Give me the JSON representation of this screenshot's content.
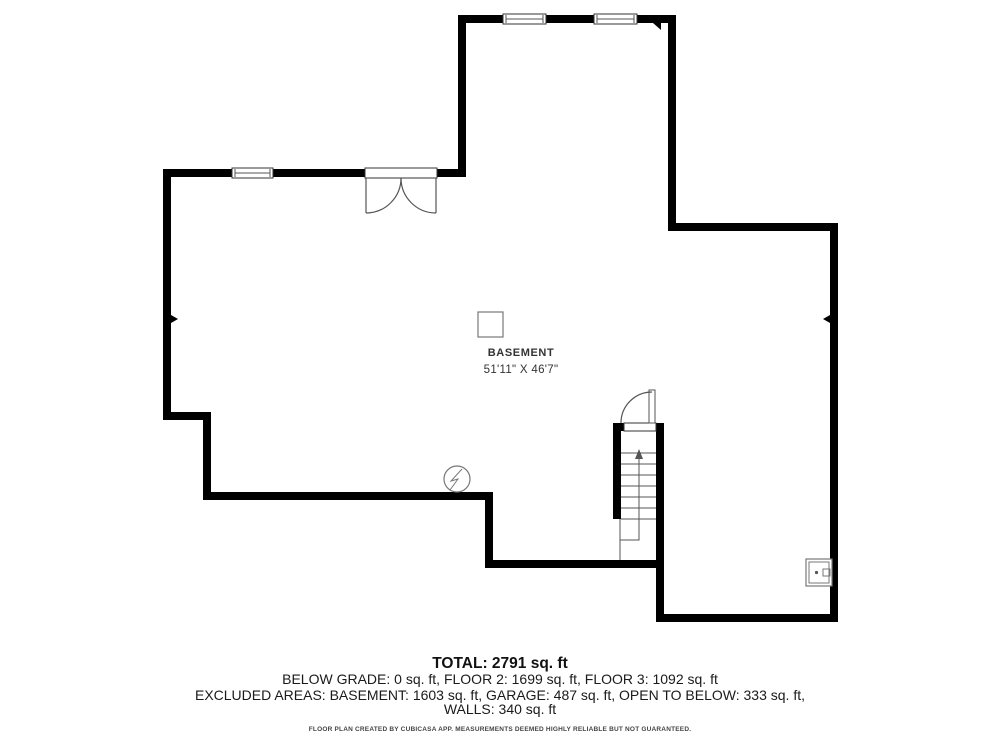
{
  "room": {
    "label": "BASEMENT",
    "dimensions": "51'11\" X 46'7\""
  },
  "summary": {
    "total": "TOTAL: 2791 sq. ft",
    "floors": "BELOW GRADE: 0 sq. ft, FLOOR 2: 1699 sq. ft, FLOOR 3: 1092 sq. ft",
    "excluded": "EXCLUDED AREAS: BASEMENT: 1603 sq. ft, GARAGE: 487 sq. ft, OPEN TO BELOW: 333 sq. ft,",
    "walls": "WALLS: 340 sq. ft"
  },
  "disclaimer": "FLOOR PLAN CREATED BY CUBICASA APP. MEASUREMENTS DEEMED HIGHLY RELIABLE BUT NOT GUARANTEED.",
  "symbols": [
    "structural-column",
    "sump-pump",
    "electrical-panel",
    "stairs-up",
    "double-door",
    "single-door",
    "window"
  ],
  "colors": {
    "wall": "#000000",
    "line": "#555555",
    "frame": "#333333",
    "symbol": "#777777",
    "text": "#1a1a1a"
  }
}
